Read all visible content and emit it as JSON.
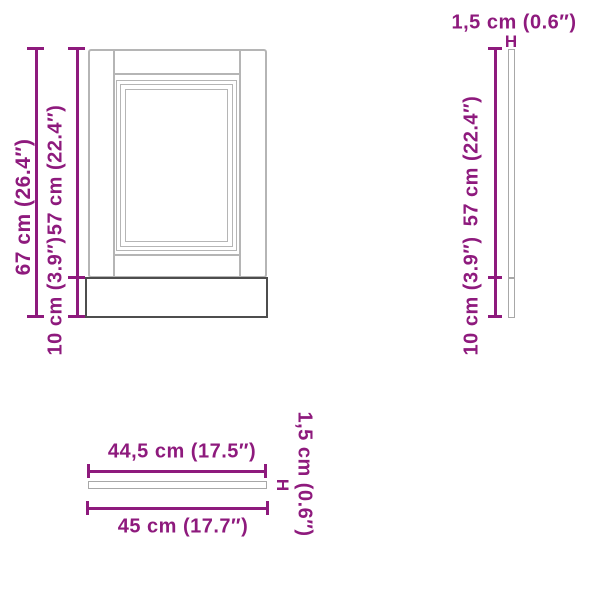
{
  "colors": {
    "accent": "#8E1A7D",
    "panel_line": "#b5b5b5",
    "panel_line_dark": "#4d4d4d",
    "thin_bar_line": "#a8a8a8",
    "background": "#ffffff"
  },
  "front_view": {
    "total_height_label": "67 cm (26.4″)",
    "door_height_label": "57 cm (22.4″)",
    "plinth_height_label": "10 cm (3.9″)"
  },
  "side_view": {
    "thickness_label": "1,5 cm (0.6″)",
    "thickness_marker": "H",
    "door_height_label": "57 cm (22.4″)",
    "plinth_height_label": "10 cm (3.9″)"
  },
  "top_view": {
    "inner_width_label": "44,5 cm (17.5″)",
    "outer_width_label": "45 cm (17.7″)",
    "thickness_marker": "H",
    "thickness_label": "1,5 cm (0.6″)"
  }
}
